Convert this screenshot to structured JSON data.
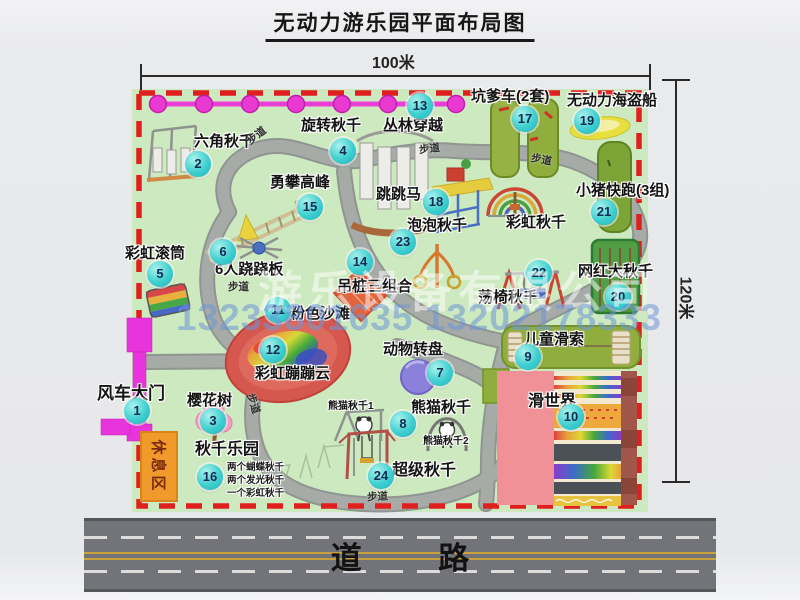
{
  "title": "无动力游乐园平面布局图",
  "dimensions": {
    "width_label": "100米",
    "height_label": "120米"
  },
  "road": {
    "label": "道 路"
  },
  "watermark": {
    "company": "游乐设备有限公司",
    "phone": "13233801635 13202178333"
  },
  "map": {
    "walkway_label": "步道",
    "rest_area": "休息区",
    "attractions": [
      {
        "id": 1,
        "name": "风车大门"
      },
      {
        "id": 2,
        "name": "六角秋千"
      },
      {
        "id": 3,
        "name": "樱花树"
      },
      {
        "id": 4,
        "name": "旋转秋千"
      },
      {
        "id": 5,
        "name": "彩虹滚筒"
      },
      {
        "id": 6,
        "name": "6人跷跷板"
      },
      {
        "id": 7,
        "name": "动物转盘"
      },
      {
        "id": 8,
        "name": "熊猫秋千"
      },
      {
        "id": 9,
        "name": "儿童滑索"
      },
      {
        "id": 10,
        "name": "滑世界"
      },
      {
        "id": 11,
        "name": "粉色沙滩"
      },
      {
        "id": 12,
        "name": "彩虹蹦蹦云"
      },
      {
        "id": 13,
        "name": "丛林穿越"
      },
      {
        "id": 14,
        "name": "吊桩三组合"
      },
      {
        "id": 15,
        "name": "勇攀高峰"
      },
      {
        "id": 16,
        "name": "秋千乐园"
      },
      {
        "id": 17,
        "name": "坑爹车(2套)"
      },
      {
        "id": 18,
        "name": "跳跳马"
      },
      {
        "id": 19,
        "name": "无动力海盗船"
      },
      {
        "id": 20,
        "name": "网红大秋千"
      },
      {
        "id": 21,
        "name": "小猪快跑(3组)"
      },
      {
        "id": 22,
        "name": "荡椅秋千"
      },
      {
        "id": 23,
        "name": "泡泡秋千"
      },
      {
        "id": 24,
        "name": "超级秋千"
      }
    ],
    "extra_labels": {
      "rainbow_swing": "彩虹秋千",
      "panda_swing_1": "熊猫秋千1",
      "panda_swing_2": "熊猫秋千2",
      "swing_park_details": [
        "两个蝴蝶秋千",
        "两个发光秋千",
        "一个彩虹秋千"
      ]
    },
    "colors": {
      "map_green": "#cde9bf",
      "border_red": "#e01f1f",
      "badge_cyan": "#3ecfd0",
      "zipline_magenta": "#ea3fd6",
      "gate_magenta": "#e834da",
      "rest_orange": "#f09a2c",
      "road_gray": "#737479"
    }
  }
}
